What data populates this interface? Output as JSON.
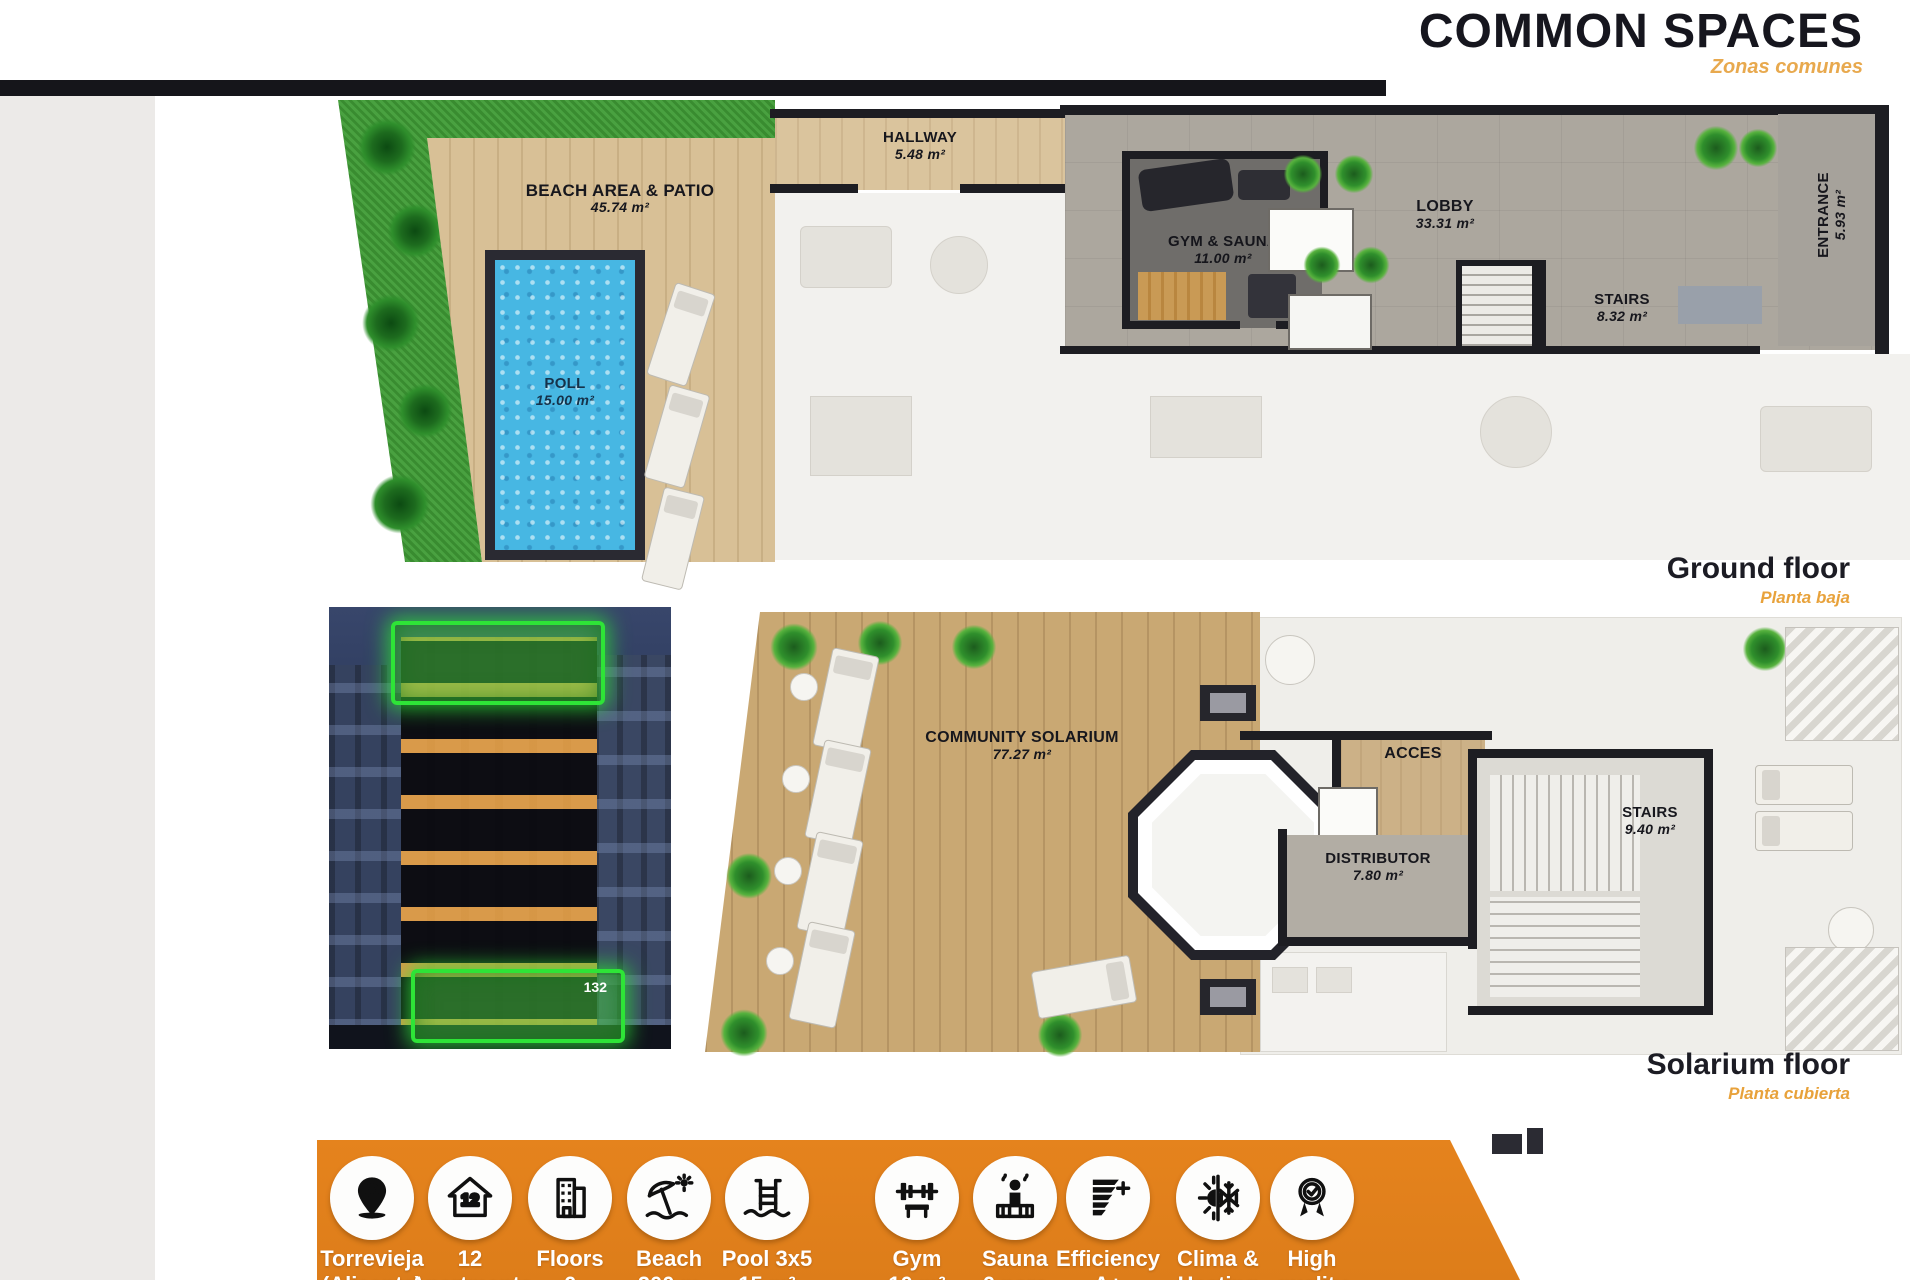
{
  "header": {
    "title": "COMMON SPACES",
    "subtitle": "Zonas comunes"
  },
  "ground_floor": {
    "caption": "Ground floor",
    "caption_localized": "Planta baja",
    "rooms": {
      "beach": {
        "name": "BEACH AREA & PATIO",
        "area": "45.74 m²"
      },
      "hallway": {
        "name": "HALLWAY",
        "area": "5.48 m²"
      },
      "gym": {
        "name": "GYM & SAUNA",
        "area": "11.00 m²"
      },
      "lobby": {
        "name": "LOBBY",
        "area": "33.31 m²"
      },
      "stairs": {
        "name": "STAIRS",
        "area": "8.32 m²"
      },
      "entrance": {
        "name": "ENTRANCE",
        "area": "5.93 m²"
      },
      "pool": {
        "name": "POLL",
        "area": "15.00 m²"
      }
    }
  },
  "solarium_floor": {
    "caption": "Solarium floor",
    "caption_localized": "Planta cubierta",
    "rooms": {
      "solarium": {
        "name": "COMMUNITY SOLARIUM",
        "area": "77.27 m²"
      },
      "acces": {
        "name": "ACCES"
      },
      "distributor": {
        "name": "DISTRIBUTOR",
        "area": "7.80 m²"
      },
      "stairs": {
        "name": "STAIRS",
        "area": "9.40 m²"
      }
    }
  },
  "building_photo": {
    "unit_badge": "132"
  },
  "features": [
    {
      "icon": "location-pin-icon",
      "line1": "Torrevieja",
      "line2": "(Alicante)"
    },
    {
      "icon": "house-count-icon",
      "line1": "12",
      "line2": "Apartments"
    },
    {
      "icon": "building-floors-icon",
      "line1": "Floors",
      "line2": "6"
    },
    {
      "icon": "beach-umbrella-icon",
      "line1": "Beach",
      "line2": "200 m"
    },
    {
      "icon": "pool-ladder-icon",
      "line1": "Pool 3x5",
      "line2": "15 m²"
    },
    {
      "icon": "gym-barbell-icon",
      "line1": "Gym",
      "line2": "10 m²"
    },
    {
      "icon": "sauna-icon",
      "line1": "Sauna",
      "line2": "6 pers"
    },
    {
      "icon": "efficiency-icon",
      "line1": "Efficiency",
      "line2": "A+"
    },
    {
      "icon": "clima-heating-icon",
      "line1": "Clima &",
      "line2": "Heating"
    },
    {
      "icon": "high-quality-icon",
      "line1": "High",
      "line2": "quality"
    }
  ],
  "colors": {
    "accent_orange": "#e2811c",
    "subtitle_orange": "#e8a23b",
    "wall_black": "#1d1d22",
    "pool_blue": "#47b7e3",
    "grass_green": "#3f9c36",
    "highlight_green": "#2ee437"
  }
}
